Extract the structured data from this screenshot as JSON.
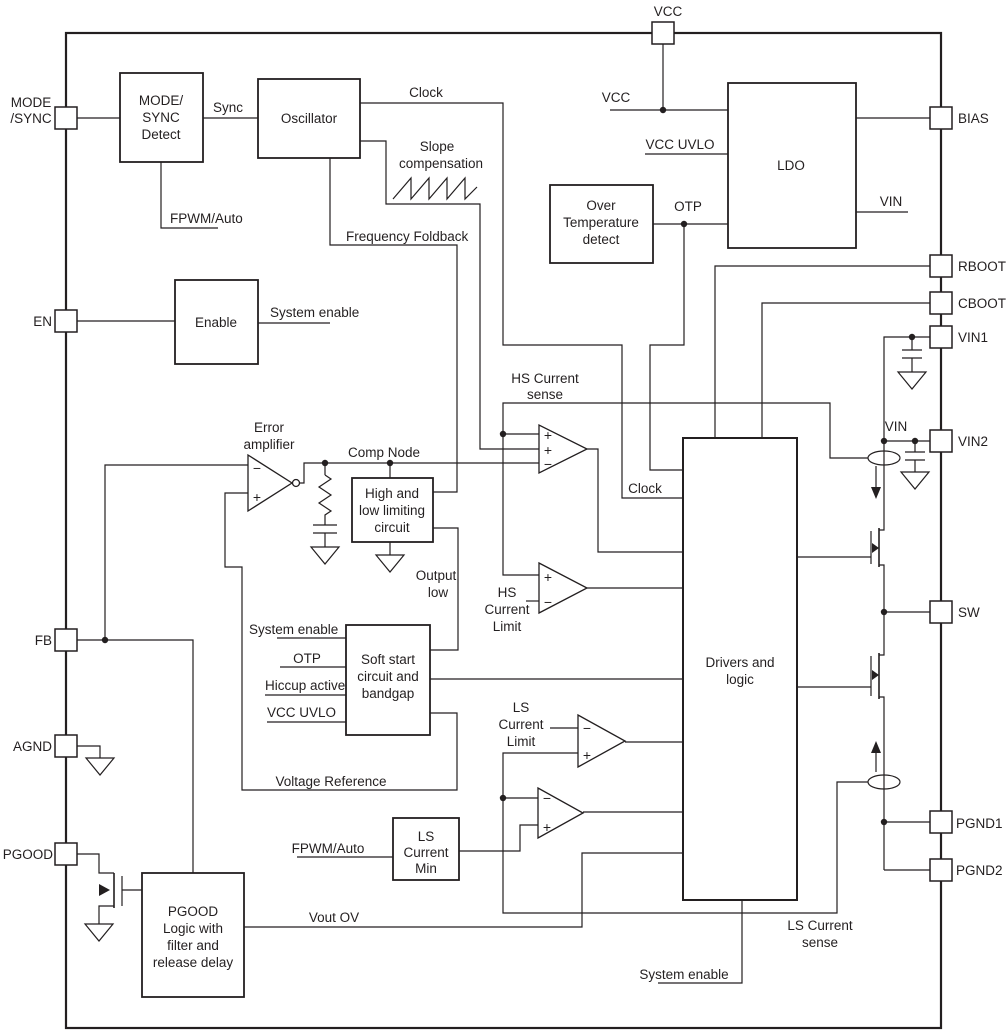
{
  "pins": {
    "mode": "MODE",
    "sync": "/SYNC",
    "en": "EN",
    "fb": "FB",
    "agnd": "AGND",
    "pgood": "PGOOD",
    "vcc": "VCC",
    "bias": "BIAS",
    "rboot": "RBOOT",
    "cboot": "CBOOT",
    "vin1": "VIN1",
    "vin2": "VIN2",
    "sw": "SW",
    "pgnd1": "PGND1",
    "pgnd2": "PGND2"
  },
  "blocks": {
    "mode_sync": {
      "l1": "MODE/",
      "l2": "SYNC",
      "l3": "Detect"
    },
    "oscillator": {
      "label": "Oscillator"
    },
    "enable": {
      "label": "Enable"
    },
    "over_temp": {
      "l1": "Over",
      "l2": "Temperature",
      "l3": "detect"
    },
    "ldo": {
      "label": "LDO"
    },
    "high_low": {
      "l1": "High and",
      "l2": "low limiting",
      "l3": "circuit"
    },
    "soft_start": {
      "l1": "Soft start",
      "l2": "circuit and",
      "l3": "bandgap"
    },
    "ls_min": {
      "l1": "LS",
      "l2": "Current",
      "l3": "Min"
    },
    "pgood_logic": {
      "l1": "PGOOD",
      "l2": "Logic with",
      "l3": "filter and",
      "l4": "release delay"
    },
    "drivers": {
      "l1": "Drivers and",
      "l2": "logic"
    }
  },
  "nets": {
    "sync": "Sync",
    "clock_top": "Clock",
    "clock_mid": "Clock",
    "fpwm_auto_top": "FPWM/Auto",
    "fpwm_auto_bot": "FPWM/Auto",
    "freq_foldback": "Frequency Foldback",
    "slope_l1": "Slope",
    "slope_l2": "compensation",
    "sys_en_enable": "System enable",
    "sys_en_soft": "System enable",
    "sys_en_bottom": "System enable",
    "vcc_ldo": "VCC",
    "vcc_uvlo_ldo": "VCC UVLO",
    "vcc_uvlo_soft": "VCC UVLO",
    "otp_ldo": "OTP",
    "otp_soft": "OTP",
    "hiccup": "Hiccup active",
    "vin_ldo": "VIN",
    "vin_fet": "VIN",
    "err_l1": "Error",
    "err_l2": "amplifier",
    "comp_node": "Comp Node",
    "out_low_l1": "Output",
    "out_low_l2": "low",
    "vref": "Voltage Reference",
    "hs_sense_l1": "HS Current",
    "hs_sense_l2": "sense",
    "hs_lim_l1": "HS",
    "hs_lim_l2": "Current",
    "hs_lim_l3": "Limit",
    "ls_lim_l1": "LS",
    "ls_lim_l2": "Current",
    "ls_lim_l3": "Limit",
    "ls_sense_l1": "LS Current",
    "ls_sense_l2": "sense",
    "vout_ov": "Vout OV"
  },
  "signs": {
    "plus": "+",
    "minus": "−"
  },
  "colors": {
    "line": "#231f20",
    "background": "#ffffff"
  }
}
